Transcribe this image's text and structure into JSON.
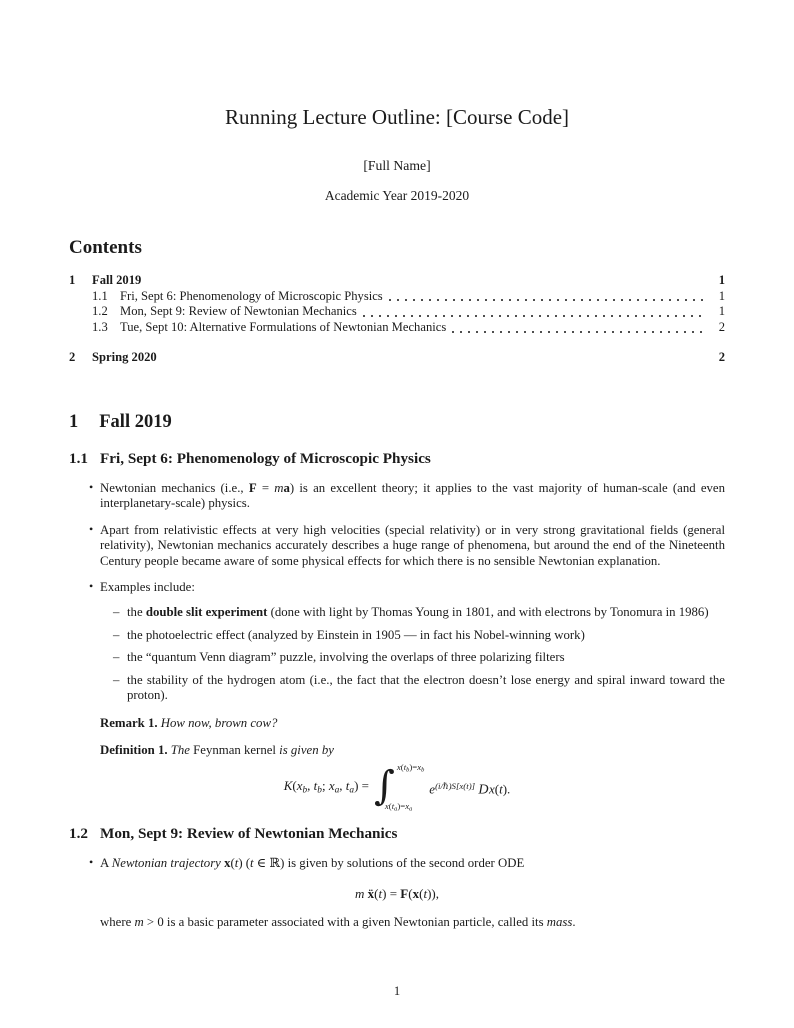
{
  "header": {
    "title": "Running Lecture Outline: [Course Code]",
    "author": "[Full Name]",
    "academic_year": "Academic Year 2019-2020"
  },
  "markers": {
    "bullet": "•",
    "dash": "–"
  },
  "contents": {
    "heading": "Contents",
    "entries": [
      {
        "num": "1",
        "label": "Fall 2019",
        "page": "1"
      },
      {
        "num": "1.1",
        "label": "Fri, Sept 6: Phenomenology of Microscopic Physics",
        "page": "1"
      },
      {
        "num": "1.2",
        "label": "Mon, Sept 9: Review of Newtonian Mechanics",
        "page": "1"
      },
      {
        "num": "1.3",
        "label": "Tue, Sept 10: Alternative Formulations of Newtonian Mechanics",
        "page": "2"
      },
      {
        "num": "2",
        "label": "Spring 2020",
        "page": "2"
      }
    ]
  },
  "sections": {
    "fall": {
      "num": "1",
      "title": "Fall 2019"
    },
    "s11": {
      "num": "1.1",
      "title": "Fri, Sept 6: Phenomenology of Microscopic Physics",
      "bullet1": [
        {
          "t": "Newtonian mechanics (i.e., "
        },
        {
          "t": "F",
          "s": "b"
        },
        {
          "t": " = "
        },
        {
          "t": "m",
          "s": "i"
        },
        {
          "t": "a",
          "s": "b"
        },
        {
          "t": ") is an excellent theory; it applies to the vast majority of human-scale (and even interplanetary-scale) physics."
        }
      ],
      "bullet2": [
        {
          "t": "Apart from relativistic effects at very high velocities (special relativity) or in very strong gravitational fields (general relativity), Newtonian mechanics accurately describes a huge range of phenomena, but around the end of the Nineteenth Century people became aware of some physical effects for which there is no sensible Newtonian explanation."
        }
      ],
      "bullet3": [
        {
          "t": "Examples include:"
        }
      ],
      "sub1": [
        {
          "t": "the "
        },
        {
          "t": "double slit experiment",
          "s": "b"
        },
        {
          "t": " (done with light by Thomas Young in 1801, and with electrons by Tonomura in 1986)"
        }
      ],
      "sub2": [
        {
          "t": "the photoelectric effect (analyzed by Einstein in 1905 — in fact his Nobel-winning work)"
        }
      ],
      "sub3": [
        {
          "t": "the “quantum Venn diagram” puzzle, involving the overlaps of three polarizing filters"
        }
      ],
      "sub4": [
        {
          "t": "the stability of the hydrogen atom (i.e., the fact that the electron doesn’t lose energy and spiral inward toward the proton)."
        }
      ],
      "remark": [
        {
          "t": "Remark 1.",
          "s": "b"
        },
        {
          "t": " How now, brown cow?",
          "s": "i"
        }
      ],
      "definition": [
        {
          "t": "Definition 1.",
          "s": "b"
        },
        {
          "t": " The ",
          "s": "i"
        },
        {
          "t": "Feynman kernel"
        },
        {
          "t": " is given by",
          "s": "i"
        }
      ],
      "kernel": {
        "lhs": [
          {
            "t": "K",
            "s": "i"
          },
          {
            "t": "("
          },
          {
            "t": "x",
            "s": "i"
          },
          {
            "t": "b",
            "s": "sub"
          },
          {
            "t": ", "
          },
          {
            "t": "t",
            "s": "i"
          },
          {
            "t": "b",
            "s": "sub"
          },
          {
            "t": "; "
          },
          {
            "t": "x",
            "s": "i"
          },
          {
            "t": "a",
            "s": "sub"
          },
          {
            "t": ", "
          },
          {
            "t": "t",
            "s": "i"
          },
          {
            "t": "a",
            "s": "sub"
          },
          {
            "t": ") ="
          }
        ],
        "integral_sign": "∫",
        "upper_limit": [
          {
            "t": "x",
            "s": "i"
          },
          {
            "t": "("
          },
          {
            "t": "t",
            "s": "i"
          },
          {
            "t": "b",
            "s": "sub"
          },
          {
            "t": ")="
          },
          {
            "t": "x",
            "s": "i"
          },
          {
            "t": "b",
            "s": "sub"
          }
        ],
        "lower_limit": [
          {
            "t": "x",
            "s": "i"
          },
          {
            "t": "("
          },
          {
            "t": "t",
            "s": "i"
          },
          {
            "t": "a",
            "s": "sub"
          },
          {
            "t": ")="
          },
          {
            "t": "x",
            "s": "i"
          },
          {
            "t": "a",
            "s": "sub"
          }
        ],
        "integrand": [
          {
            "t": "e",
            "s": "i"
          },
          {
            "t": "(i/ℏ)S[x(t)]",
            "s": "sup"
          },
          {
            "t": " "
          },
          {
            "t": "D",
            "s": "scr"
          },
          {
            "t": "x",
            "s": "i"
          },
          {
            "t": "("
          },
          {
            "t": "t",
            "s": "i"
          },
          {
            "t": ")."
          }
        ]
      }
    },
    "s12": {
      "num": "1.2",
      "title": "Mon, Sept 9: Review of Newtonian Mechanics",
      "bullet1": [
        {
          "t": "A "
        },
        {
          "t": "Newtonian trajectory ",
          "s": "i"
        },
        {
          "t": "x",
          "s": "b"
        },
        {
          "t": "("
        },
        {
          "t": "t",
          "s": "i"
        },
        {
          "t": ") ("
        },
        {
          "t": "t",
          "s": "i"
        },
        {
          "t": " ∈ ℝ) is given by solutions of the second order ODE"
        }
      ],
      "ode": [
        {
          "t": "m",
          "s": "i"
        },
        {
          "t": " "
        },
        {
          "t": "ẍ",
          "s": "b"
        },
        {
          "t": "("
        },
        {
          "t": "t",
          "s": "i"
        },
        {
          "t": ") = "
        },
        {
          "t": "F",
          "s": "b"
        },
        {
          "t": "("
        },
        {
          "t": "x",
          "s": "b"
        },
        {
          "t": "("
        },
        {
          "t": "t",
          "s": "i"
        },
        {
          "t": ")),"
        }
      ],
      "where": [
        {
          "t": "where "
        },
        {
          "t": "m",
          "s": "i"
        },
        {
          "t": " > 0 is a basic parameter associated with a given Newtonian particle, called its "
        },
        {
          "t": "mass",
          "s": "i"
        },
        {
          "t": "."
        }
      ]
    }
  },
  "footer": {
    "page_number": "1"
  }
}
